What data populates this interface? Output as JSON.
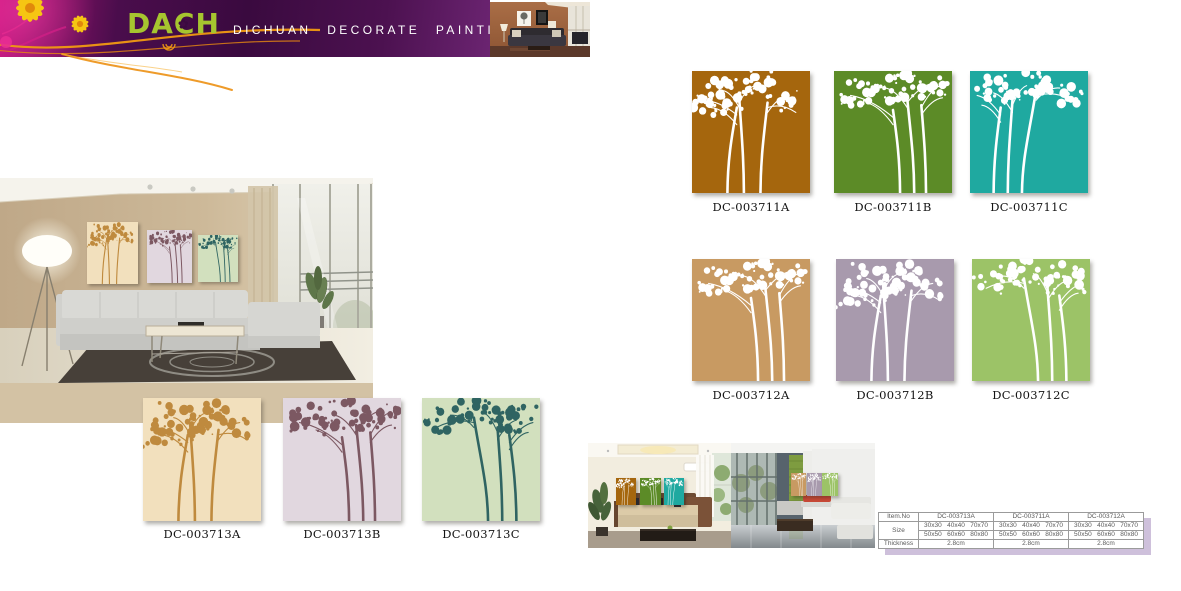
{
  "header": {
    "logo_parts": [
      "DA",
      "C",
      "H"
    ],
    "flower_glyph": "✿",
    "tagline": "DICHUAN DECORATE PAINTING",
    "colors": {
      "banner_magenta": "#C4157E",
      "banner_purple": "#3A0A3F",
      "logo_green": "#A6C52F",
      "ornament_orange": "#F09A12"
    }
  },
  "catalog": {
    "rows": [
      {
        "name": "row-711",
        "items": [
          {
            "code": "DC-003711A",
            "bg": "#A5660D",
            "fg": "#FFFFFF"
          },
          {
            "code": "DC-003711B",
            "bg": "#5C8B27",
            "fg": "#FFFFFF"
          },
          {
            "code": "DC-003711C",
            "bg": "#1FA9A0",
            "fg": "#FFFFFF"
          }
        ]
      },
      {
        "name": "row-712",
        "items": [
          {
            "code": "DC-003712A",
            "bg": "#C89A62",
            "fg": "#FFFFFF"
          },
          {
            "code": "DC-003712B",
            "bg": "#A89AAD",
            "fg": "#FFFFFF"
          },
          {
            "code": "DC-003712C",
            "bg": "#9CC367",
            "fg": "#FFFFFF"
          }
        ]
      },
      {
        "name": "row-713",
        "items": [
          {
            "code": "DC-003713A",
            "bg": "#F2E0BD",
            "fg": "#BF8A3E"
          },
          {
            "code": "DC-003713B",
            "bg": "#E1D7DF",
            "fg": "#7C5862"
          },
          {
            "code": "DC-003713C",
            "bg": "#D2E0BE",
            "fg": "#2F6462"
          }
        ]
      }
    ]
  },
  "spec_table": {
    "row_labels": [
      "Item.No",
      "Size",
      "Thickness"
    ],
    "columns": [
      {
        "item_no": "DC-003713A",
        "sizes_1": "30x30   40x40   70x70",
        "sizes_2": "50x50   60x60   80x80",
        "thickness": "2.8cm"
      },
      {
        "item_no": "DC-003711A",
        "sizes_1": "30x30   40x40   70x70",
        "sizes_2": "50x50   60x60   80x80",
        "thickness": "2.8cm"
      },
      {
        "item_no": "DC-003712A",
        "sizes_1": "30x30   40x40   70x70",
        "sizes_2": "50x50   60x60   80x80",
        "thickness": "2.8cm"
      }
    ]
  }
}
